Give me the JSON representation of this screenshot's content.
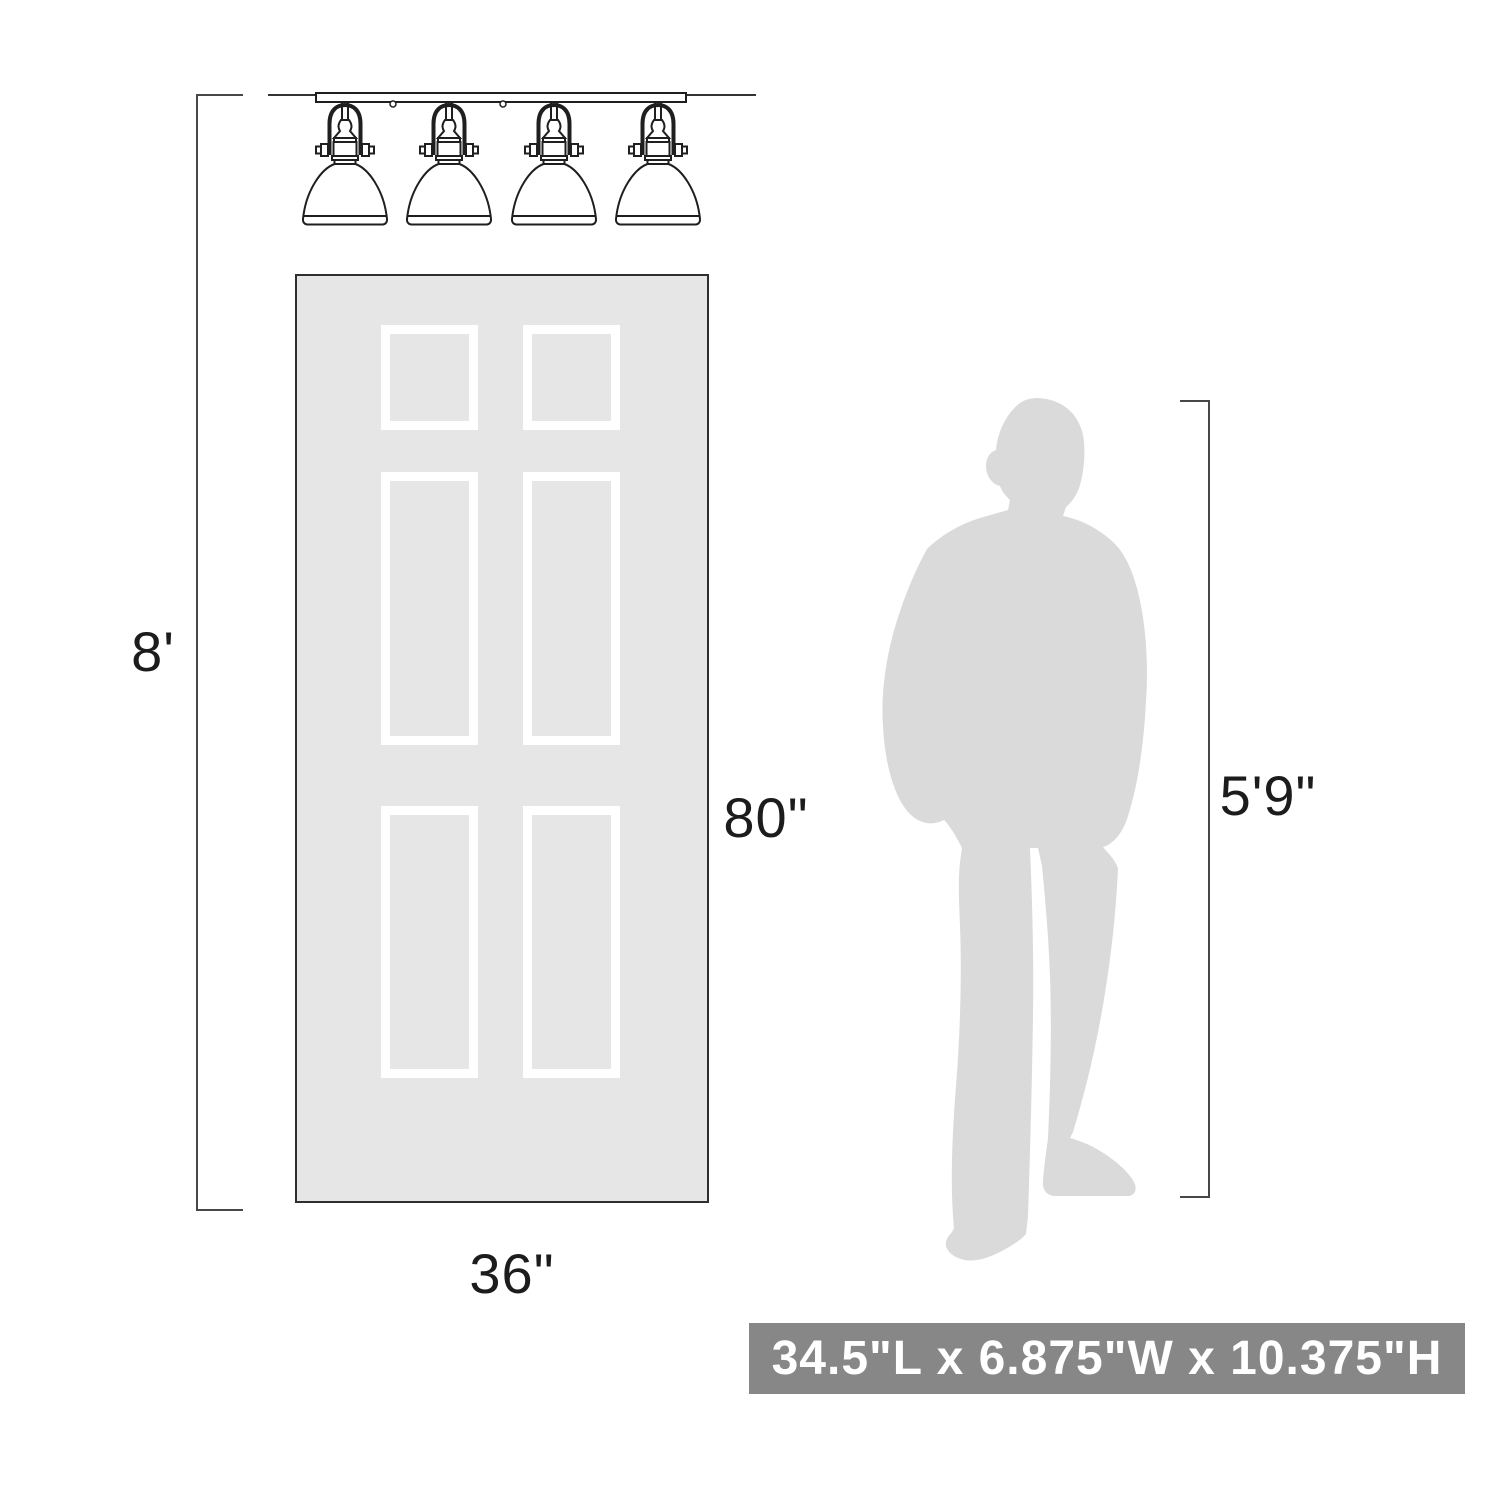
{
  "title": "4-light vanity fixture dimension diagram",
  "labels": {
    "ceiling_height": "8'",
    "door_height": "80\"",
    "door_width": "36\"",
    "person_height": "5'9\""
  },
  "banner": {
    "text": "34.5\"L x 6.875\"W x 10.375\"H"
  },
  "figures": {
    "fixture": "4-light-vanity-bath-fixture",
    "door": "6-panel-door",
    "person": "standing-man-silhouette"
  },
  "colors": {
    "door_fill": "#e6e6e6",
    "door_border": "#2f2f2f",
    "panel_frame": "#ffffff",
    "silhouette": "#dadada",
    "dimension_line": "#474747",
    "fixture_line": "#1f1f1f",
    "banner_bg": "#878787",
    "banner_text": "#ffffff",
    "label_text": "#1c1c1c"
  }
}
